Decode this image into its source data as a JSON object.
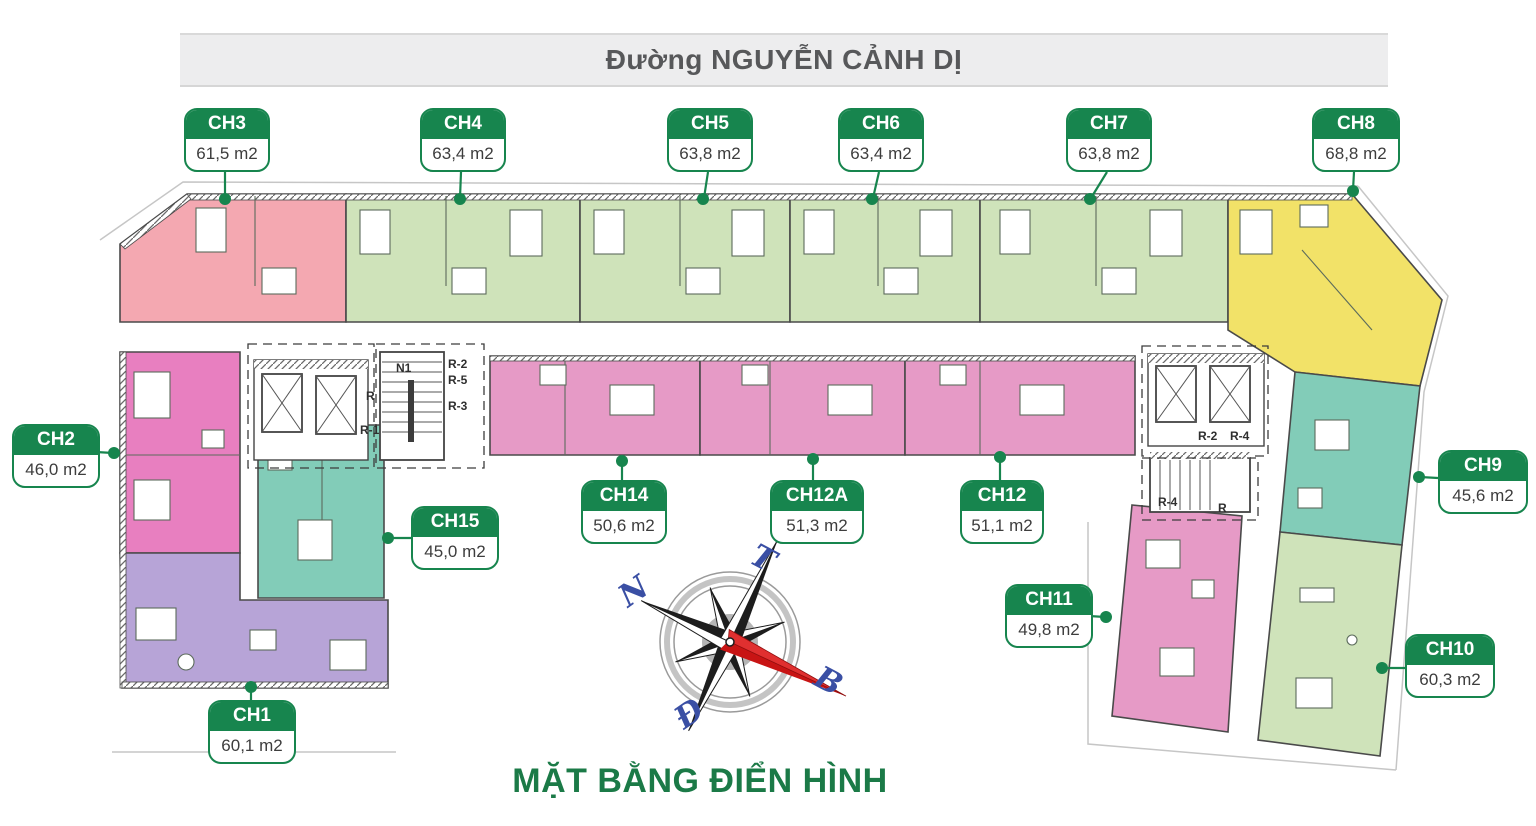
{
  "street_label": "Đường NGUYỄN CẢNH DỊ",
  "plan_title": "MẶT BẰNG ĐIỂN HÌNH",
  "apartments": [
    {
      "id": "CH1",
      "area": "60,1 m2"
    },
    {
      "id": "CH2",
      "area": "46,0 m2"
    },
    {
      "id": "CH3",
      "area": "61,5 m2"
    },
    {
      "id": "CH4",
      "area": "63,4 m2"
    },
    {
      "id": "CH5",
      "area": "63,8 m2"
    },
    {
      "id": "CH6",
      "area": "63,4 m2"
    },
    {
      "id": "CH7",
      "area": "63,8 m2"
    },
    {
      "id": "CH8",
      "area": "68,8 m2"
    },
    {
      "id": "CH9",
      "area": "45,6 m2"
    },
    {
      "id": "CH10",
      "area": "60,3 m2"
    },
    {
      "id": "CH11",
      "area": "49,8 m2"
    },
    {
      "id": "CH12",
      "area": "51,1 m2"
    },
    {
      "id": "CH12A",
      "area": "51,3 m2"
    },
    {
      "id": "CH14",
      "area": "50,6 m2"
    },
    {
      "id": "CH15",
      "area": "45,0 m2"
    }
  ],
  "cores": {
    "n1": "N1",
    "r": "R",
    "r1": "R-1",
    "r2": "R-2",
    "r5": "R-5",
    "r3": "R-3",
    "right_r2": "R-2",
    "right_r4": "R-4",
    "stair_r4": "R-4",
    "stair_r": "R"
  },
  "compass": {
    "north_label": "B",
    "south_label": "N",
    "east_label": "Đ",
    "west_label": "T"
  },
  "colors": {
    "badge_green": "#17854e",
    "title_green": "#1b7a47",
    "pink": "#f4a8b1",
    "green": "#cfe3ba",
    "yellow": "#f2e268",
    "teal": "#82ccb8",
    "magenta": "#e69ac6",
    "magenta2": "#e87fc0",
    "purple": "#b7a4d7",
    "wall": "#4a4a4a",
    "compass_blue": "#3a4fa4",
    "compass_red": "#c81414"
  }
}
